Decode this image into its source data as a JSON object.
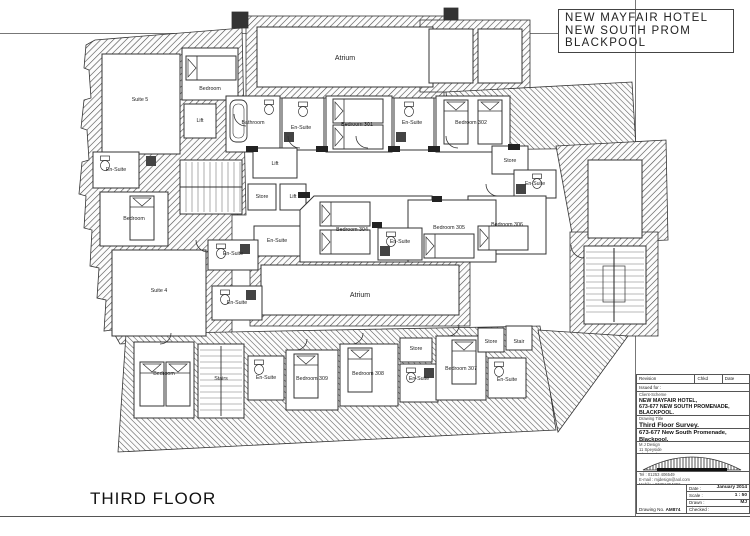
{
  "sheet": {
    "floor_label": "THIRD FLOOR",
    "top_title_line1": "NEW MAYFAIR HOTEL",
    "top_title_line2": "NEW SOUTH PROM",
    "top_title_line3": "BLACKPOOL"
  },
  "title_block": {
    "revision_label": "Revision",
    "chkd_label": "Chkd",
    "date_col_label": "Date",
    "issued_for_label": "Issued for :",
    "client_scheme_label": "Client-Scheme",
    "client_line1": "NEW MAYFAIR HOTEL,",
    "client_line2": "673-677 NEW SOUTH PROMENADE,",
    "client_line3": "BLACKPOOL.",
    "drawing_title_label": "Drawing Title",
    "drawing_title": "Third Floor Survey.",
    "address_line": "673-677 New South Promenade, Blackpool.",
    "firm_name": "M J Design",
    "firm_addr1": "11 Speyside",
    "firm_addr2": "Blackpool",
    "firm_addr3": "FY4 2BS",
    "tel": "Tel : 01253 406549",
    "email": "E-mail : mjdesign@aol.com",
    "mobile": "Mobile : 07791394802",
    "date_label": "Date :",
    "date_value": "January 2014",
    "scale_label": "Scale :",
    "scale_value": "1 : 50",
    "drawn_label": "Drawn :",
    "drawn_value": "MJ",
    "checked_label": "Checked :",
    "checked_value": "",
    "drawing_no_label": "Drawing No.",
    "drawing_no_value": "AM874"
  },
  "plan": {
    "labels": [
      "Atrium",
      "Bedroom",
      "Suite 5",
      "Lift",
      "Bathroom",
      "En-Suite",
      "Bedroom 301",
      "En-Suite",
      "Bedroom 302",
      "En-Suite",
      "Lift",
      "Store",
      "En-Suite",
      "Store",
      "Lift",
      "Bedroom",
      "Bedroom 306",
      "Bedroom 304",
      "Bedroom 305",
      "En-Suite",
      "En-Suite",
      "En-Suite",
      "Suite 4",
      "Atrium",
      "En-Suite",
      "Bedroom",
      "Stairs",
      "En-Suite",
      "Bedroom 309",
      "Bedroom 308",
      "Store",
      "En-Suite",
      "Bedroom 307",
      "Store",
      "Stair",
      "En-Suite"
    ]
  }
}
